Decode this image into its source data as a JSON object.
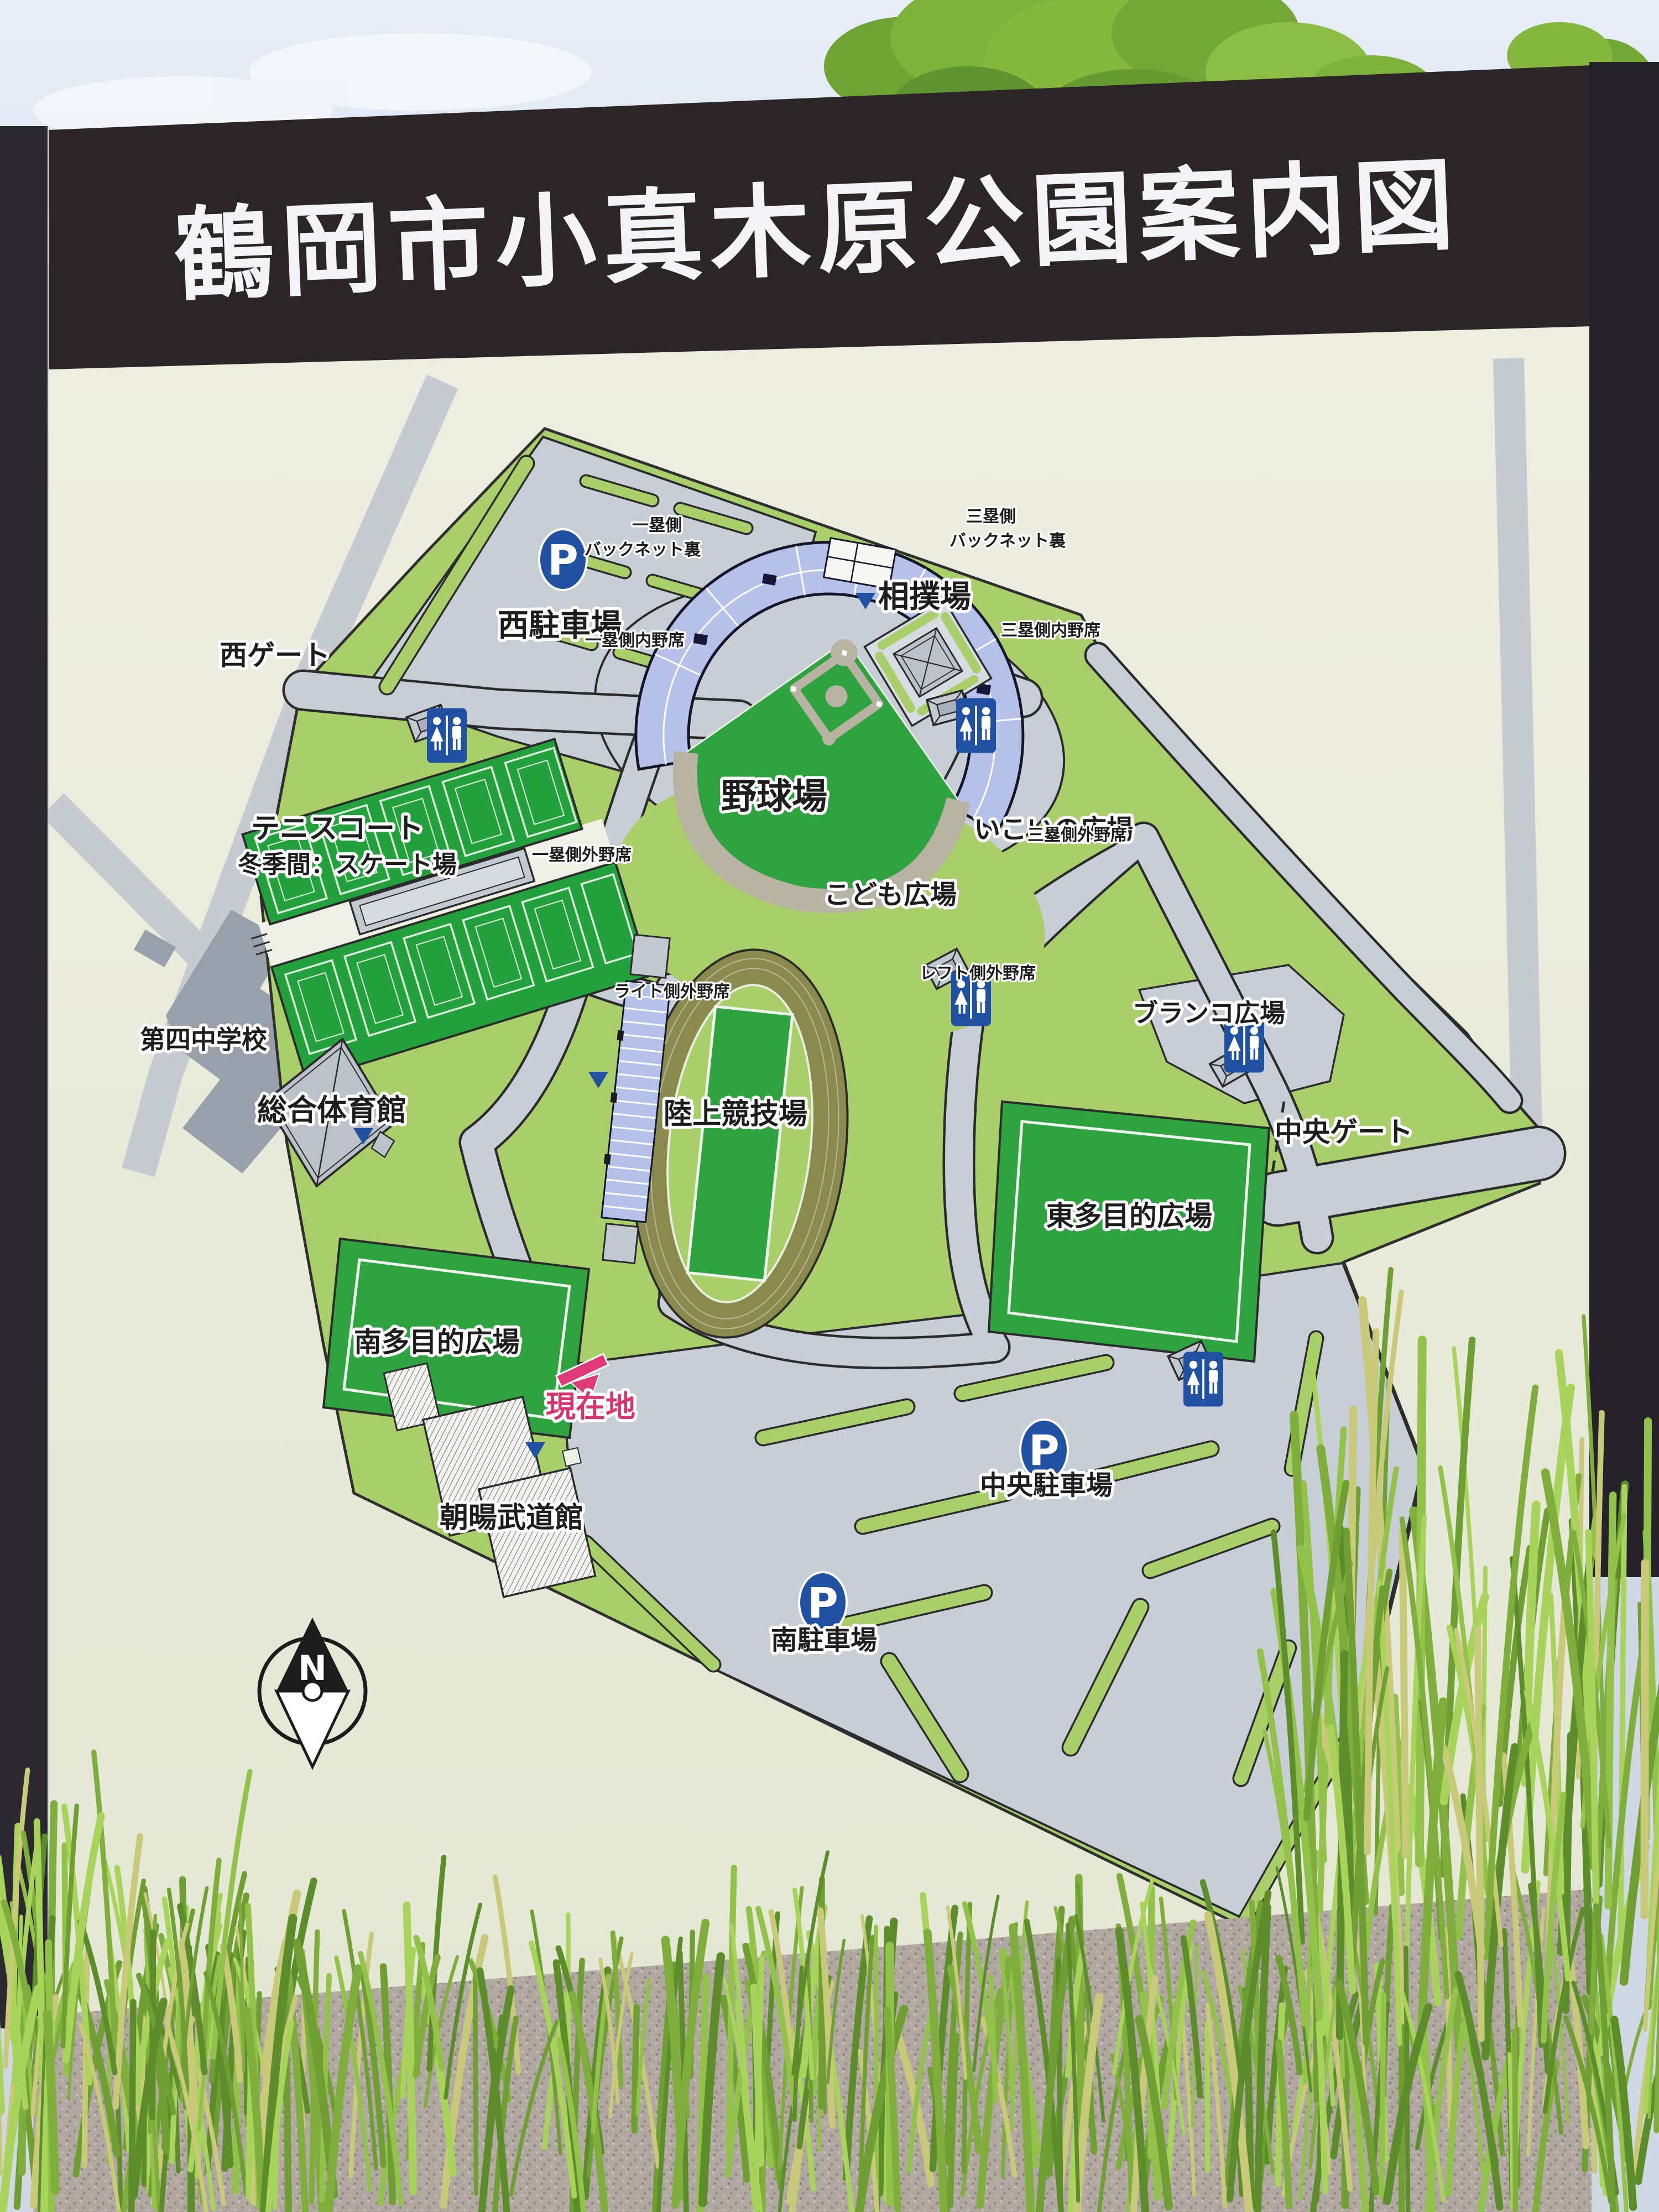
{
  "sign": {
    "title": "鶴岡市小真木原公園案内図"
  },
  "map": {
    "facilities": {
      "baseball_stadium": "野球場",
      "sumo_ring": "相撲場",
      "tennis_court": "テニスコート",
      "tennis_court_winter": "冬季間：スケート場",
      "junior_high_school": "第四中学校",
      "gymnasium": "総合体育館",
      "athletics_stadium": "陸上競技場",
      "east_multipurpose_field": "東多目的広場",
      "south_multipurpose_field": "南多目的広場",
      "budokan": "朝暘武道館",
      "kids_plaza": "こども広場",
      "ikoi_plaza": "いこいの広場",
      "swing_plaza": "ブランコ広場"
    },
    "gates": {
      "west_gate": "西ゲート",
      "central_gate": "中央ゲート"
    },
    "parking": {
      "west": "西駐車場",
      "central": "中央駐車場",
      "south": "南駐車場",
      "icon_letter": "P"
    },
    "stadium_seating": {
      "first_base_backnet_line1": "一塁側",
      "first_base_backnet_line2": "バックネット裏",
      "third_base_backnet_line1": "三塁側",
      "third_base_backnet_line2": "バックネット裏",
      "first_base_infield": "一塁側内野席",
      "third_base_infield": "三塁側内野席",
      "first_base_outfield": "一塁側外野席",
      "third_base_outfield": "三塁側外野席",
      "right_outfield": "ライト側外野席",
      "left_outfield": "レフト側外野席"
    },
    "markers": {
      "current_location": "現在地",
      "compass_north": "N"
    },
    "colors": {
      "lawn_green": "#a9cf6b",
      "field_green": "#2ea33f",
      "road_gray": "#c8ced6",
      "track_olive": "#8a8a4f",
      "seating_blue": "#b5c1e8",
      "toilet_blue": "#2051a3",
      "parking_blue": "#2051a3",
      "current_location_pink": "#e13a78",
      "panel_beige": "#e9ebdc",
      "header_black": "#2b2528"
    }
  }
}
